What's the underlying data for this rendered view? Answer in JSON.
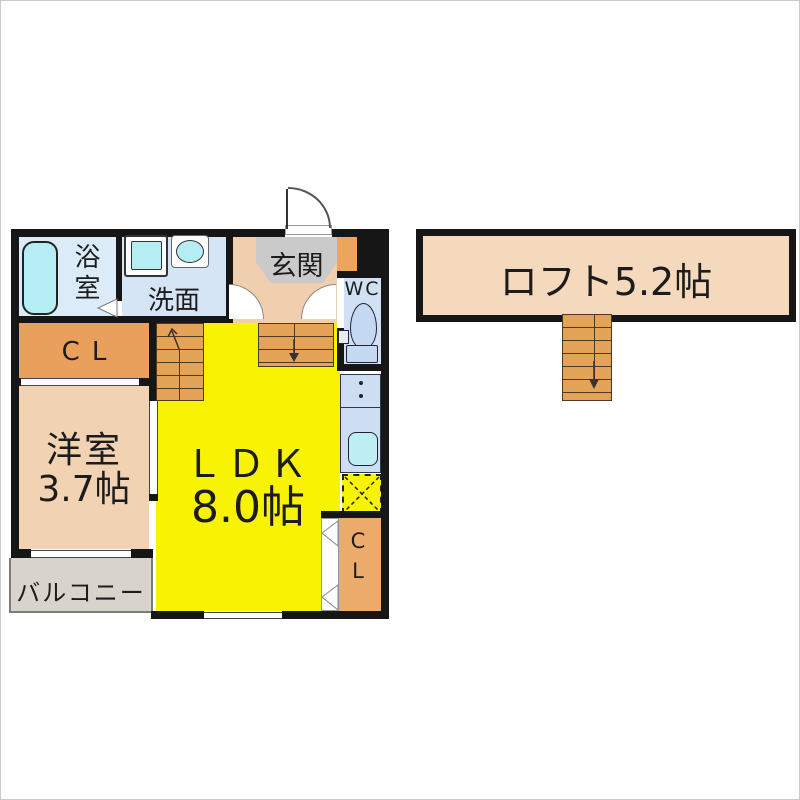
{
  "floor1": {
    "bathroom_label": "浴室",
    "washroom_label": "洗面",
    "entrance_label": "玄関",
    "wc_label": "WC",
    "closet_left_label": "CL",
    "western_room_name": "洋室",
    "western_room_size": "3.7帖",
    "ldk_name": "ＬＤＫ",
    "ldk_size": "8.0帖",
    "balcony_label": "バルコニー",
    "closet_right_label": "CL"
  },
  "loft": {
    "label": "ロフト5.2帖"
  },
  "colors": {
    "wall": "#161616",
    "ldk_yellow": "#f8f303",
    "room_peach": "#f1d2b2",
    "hallway_peach": "#efcfad",
    "loft_peach": "#f5d9bd",
    "closet_orange": "#e9a05c",
    "stairs_orange": "#e5a357",
    "water_blue": "#d5e5f5",
    "fixture_cyan": "#b4edf3",
    "toilet_blue": "#c5d9f2",
    "entrance_gray": "#cacaca",
    "balcony_gray": "#d8d4cb"
  }
}
